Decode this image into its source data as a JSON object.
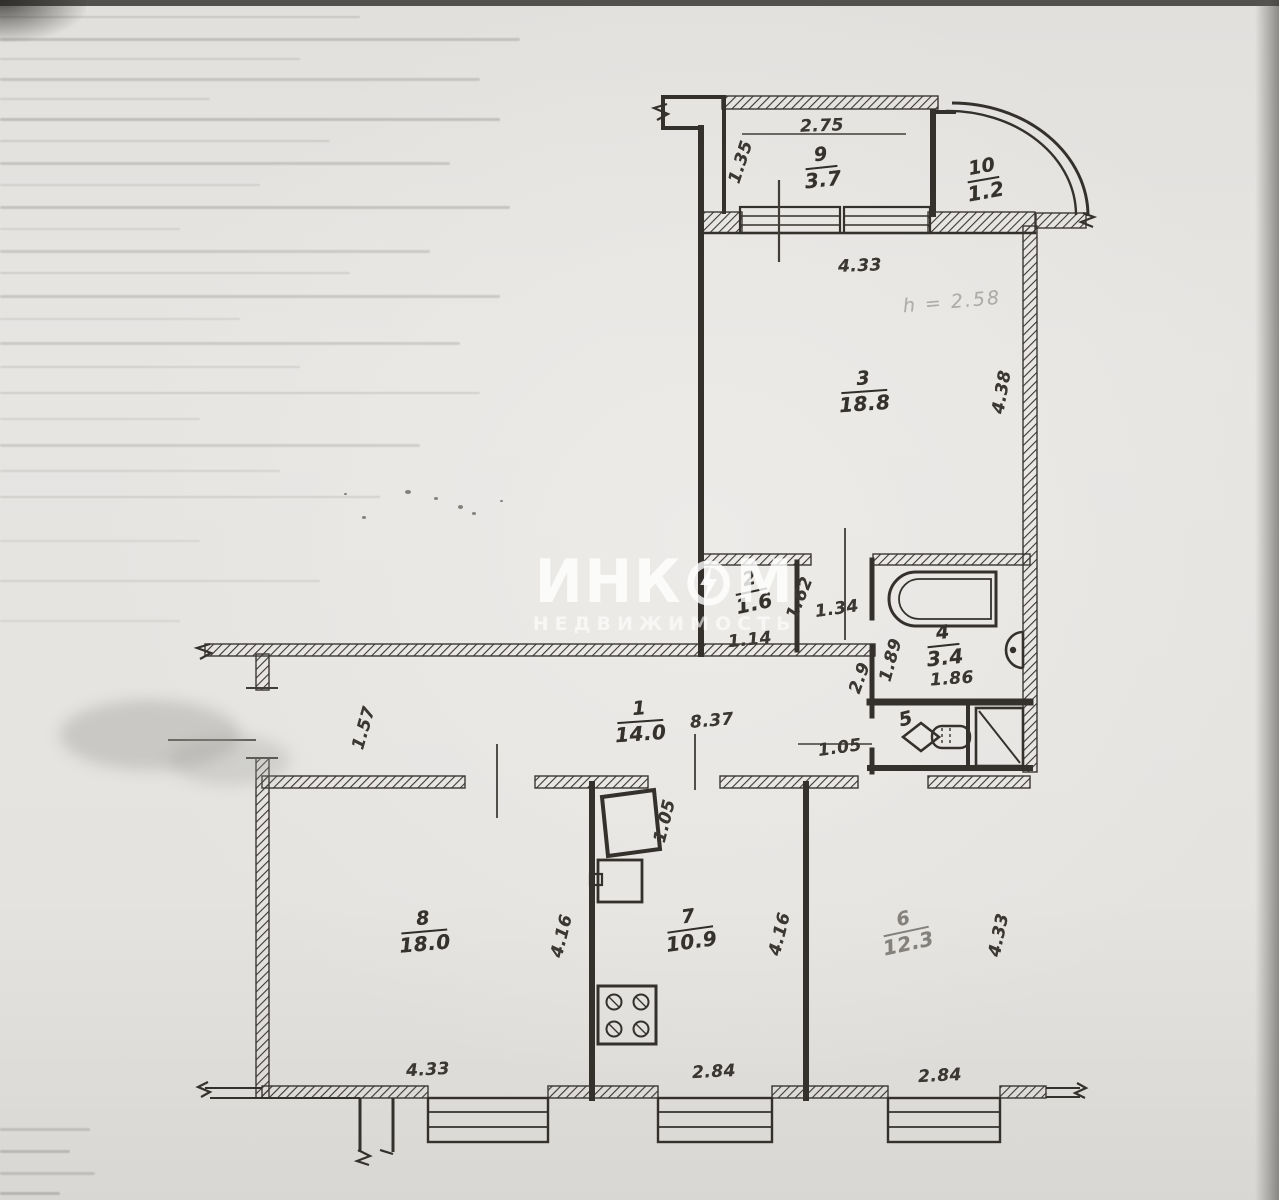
{
  "document": {
    "type": "apartment floor plan (scanned BTI drawing)",
    "ink_color": "#34312d",
    "paper_color": "#e5e3e0"
  },
  "watermark": {
    "brand_left": "ИНК",
    "brand_right": "М",
    "brand_full": "ИНКОМ",
    "subtitle": "НЕДВИЖИМОСТЬ",
    "color": "#ffffff"
  },
  "plan": {
    "rooms": [
      {
        "number": "9",
        "area": "3.7",
        "x": 822,
        "y": 168,
        "rot": -6
      },
      {
        "number": "10",
        "area": "1.2",
        "x": 984,
        "y": 180,
        "rot": -10
      },
      {
        "number": "3",
        "area": "18.8",
        "x": 864,
        "y": 392,
        "rot": -4
      },
      {
        "number": "2",
        "area": "1.6",
        "x": 752,
        "y": 592,
        "rot": -12
      },
      {
        "number": "4",
        "area": "3.4",
        "x": 944,
        "y": 646,
        "rot": -6
      },
      {
        "number": "5",
        "area": "",
        "x": 906,
        "y": 720,
        "rot": -14
      },
      {
        "number": "1",
        "area": "14.0",
        "x": 640,
        "y": 722,
        "rot": -4
      },
      {
        "number": "8",
        "area": "18.0",
        "x": 424,
        "y": 932,
        "rot": -5
      },
      {
        "number": "7",
        "area": "10.9",
        "x": 690,
        "y": 930,
        "rot": -8
      },
      {
        "number": "6",
        "area": "12.3",
        "x": 906,
        "y": 932,
        "rot": -12,
        "faint": true
      }
    ],
    "dimensions": [
      {
        "text": "2.75",
        "x": 822,
        "y": 126,
        "rot": -2
      },
      {
        "text": "1.35",
        "x": 741,
        "y": 162,
        "rot": -72
      },
      {
        "text": "4.33",
        "x": 860,
        "y": 266,
        "rot": -2
      },
      {
        "text": "4.38",
        "x": 1002,
        "y": 392,
        "rot": -80
      },
      {
        "text": "1.62",
        "x": 800,
        "y": 598,
        "rot": -68
      },
      {
        "text": "1.34",
        "x": 837,
        "y": 609,
        "rot": -8
      },
      {
        "text": "1.14",
        "x": 750,
        "y": 640,
        "rot": -6
      },
      {
        "text": "1.89",
        "x": 891,
        "y": 660,
        "rot": -75
      },
      {
        "text": "1.86",
        "x": 952,
        "y": 679,
        "rot": -4
      },
      {
        "text": "2.9",
        "x": 860,
        "y": 678,
        "rot": -70
      },
      {
        "text": "1.05",
        "x": 840,
        "y": 748,
        "rot": -8
      },
      {
        "text": "1.57",
        "x": 364,
        "y": 728,
        "rot": -74
      },
      {
        "text": "8.37",
        "x": 712,
        "y": 721,
        "rot": -5
      },
      {
        "text": "1.05",
        "x": 665,
        "y": 821,
        "rot": -76
      },
      {
        "text": "4.16",
        "x": 562,
        "y": 936,
        "rot": -76
      },
      {
        "text": "4.16",
        "x": 780,
        "y": 934,
        "rot": -76
      },
      {
        "text": "4.33",
        "x": 999,
        "y": 935,
        "rot": -78
      },
      {
        "text": "4.33",
        "x": 428,
        "y": 1070,
        "rot": -3
      },
      {
        "text": "2.84",
        "x": 714,
        "y": 1072,
        "rot": -3
      },
      {
        "text": "2.84",
        "x": 940,
        "y": 1076,
        "rot": -3
      }
    ],
    "height_note": {
      "text": "h = 2.58",
      "x": 952,
      "y": 302,
      "rot": -5
    }
  }
}
